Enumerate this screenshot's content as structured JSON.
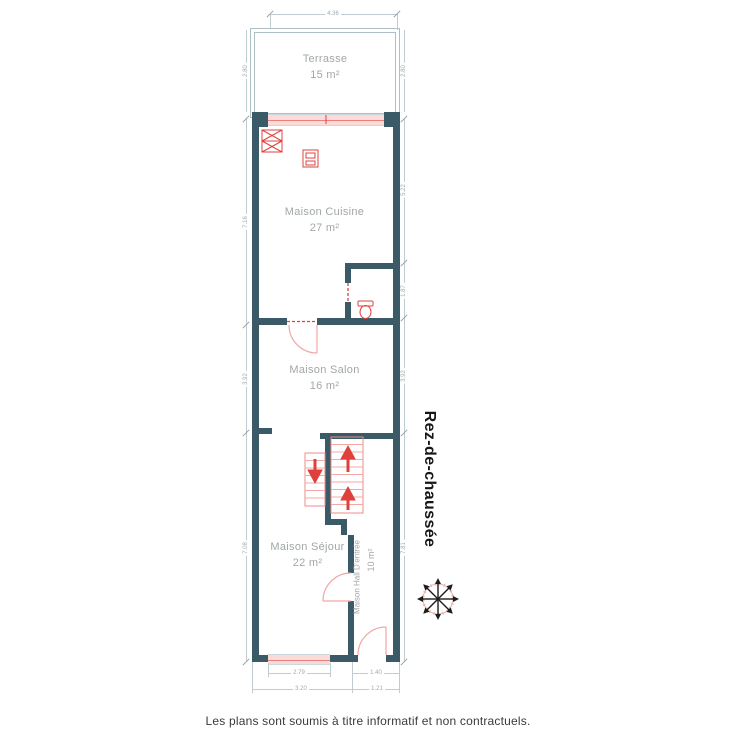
{
  "floor": {
    "label": "Rez-de-chaussée"
  },
  "rooms": [
    {
      "name": "Terrasse",
      "area": "15 m²"
    },
    {
      "name": "Maison Cuisine",
      "area": "27 m²"
    },
    {
      "name": "Maison Salon",
      "area": "16 m²"
    },
    {
      "name": "Maison Séjour",
      "area": "22 m²"
    },
    {
      "name": "Maison Hall D'entrée",
      "area": "10 m²"
    }
  ],
  "dimensions": {
    "terrace_width": "4.36",
    "terrace_height_left": "2.80",
    "terrace_height_right": "2.80",
    "kitchen_height_left": "7.16",
    "kitchen_height_right": "5.22",
    "wc_height": "1.87",
    "salon_height_left": "3.92",
    "salon_height_right": "3.92",
    "sejour_height_left": "7.08",
    "sejour_height_right": "7.81",
    "window_width": "2.79",
    "hall_width": "1.40",
    "sejour_width": "3.20",
    "hall_outer_width": "1.21"
  },
  "icons": {
    "compass": "compass-rose",
    "stove": "stove",
    "sink": "sink",
    "toilet": "toilet",
    "stairs_up": "up-arrow",
    "stairs_down": "down-arrow"
  },
  "colors": {
    "wall": "#3a5a68",
    "fixtures": "#e0403c",
    "stairs": "#f09a96",
    "window_fill": "#fbdbda",
    "dimension": "#bfccd1",
    "room_label": "#a2a7a9"
  },
  "footer": {
    "disclaimer": "Les plans sont soumis à titre informatif et non contractuels."
  }
}
